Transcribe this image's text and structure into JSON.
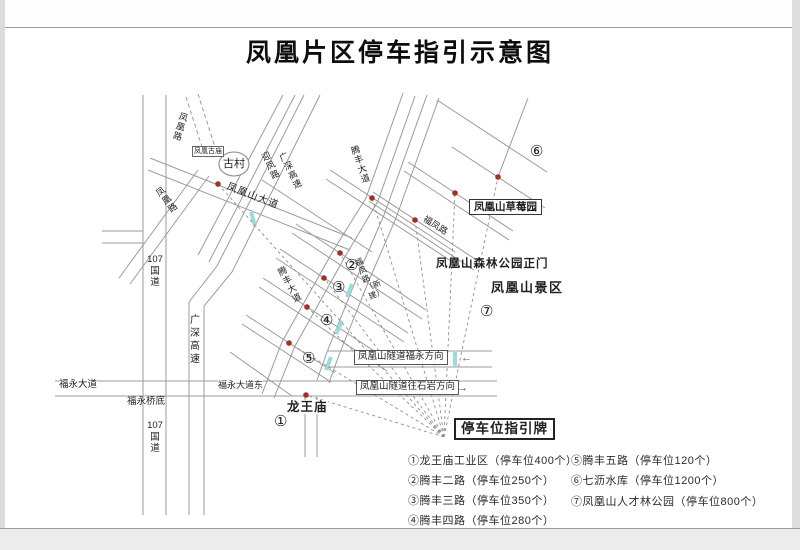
{
  "title": "凤凰片区停车指引示意图",
  "colors": {
    "road_gray": "#9b9b9b",
    "dot_red": "#a03028",
    "tunnel_cyan": "#9adbdb"
  },
  "labels": {
    "gucun": "古村",
    "fenghuang_rd_dashed": "凤凰路",
    "fenghuang_gumiao": "凤凰古庙",
    "fenghuang_rd": "凤凰路",
    "fenghuangshan_ave": "凤凰山大道",
    "yingfeng_rd": "迎凤路",
    "guangshen_expwy_upper": "广深高速",
    "guangshen_expwy_lower": "广深高速",
    "g107_upper": "107\n国\n道",
    "g107_lower": "107\n国\n道",
    "tengfeng_ave_upper": "腾丰大道",
    "tengfeng_ave_lower": "腾丰大道",
    "fufeng_rd": "福凤路",
    "fufeng_rd_new": "福凤路（新建）",
    "strawberry_park": "凤凰山草莓园",
    "forest_park_gate": "凤凰山森林公园正门",
    "scenic_area": "凤凰山景区",
    "tunnel_fuyong": "凤凰山隧道福永方向",
    "tunnel_shiyan": "凤凰山隧道往石岩方向",
    "fuyong_ave": "福永大道",
    "fuyong_bridge": "福永桥底",
    "fuyong_ave_east": "福永大道东",
    "longwang_temple": "龙王庙",
    "parking_sign": "停车位指引牌",
    "arrow_left": "←",
    "arrow_right": "→"
  },
  "markers": {
    "m1": "①",
    "m2": "②",
    "m3": "③",
    "m4": "④",
    "m5": "⑤",
    "m6": "⑥",
    "m7": "⑦"
  },
  "legend": {
    "col1": [
      "①龙王庙工业区（停车位400个）",
      "②腾丰二路（停车位250个）",
      "③腾丰三路（停车位350个）",
      "④腾丰四路（停车位280个）"
    ],
    "col2": [
      "⑤腾丰五路（停车位120个）",
      "⑥七沥水库（停车位1200个）",
      "⑦凤凰山人才林公园（停车位800个）"
    ]
  }
}
